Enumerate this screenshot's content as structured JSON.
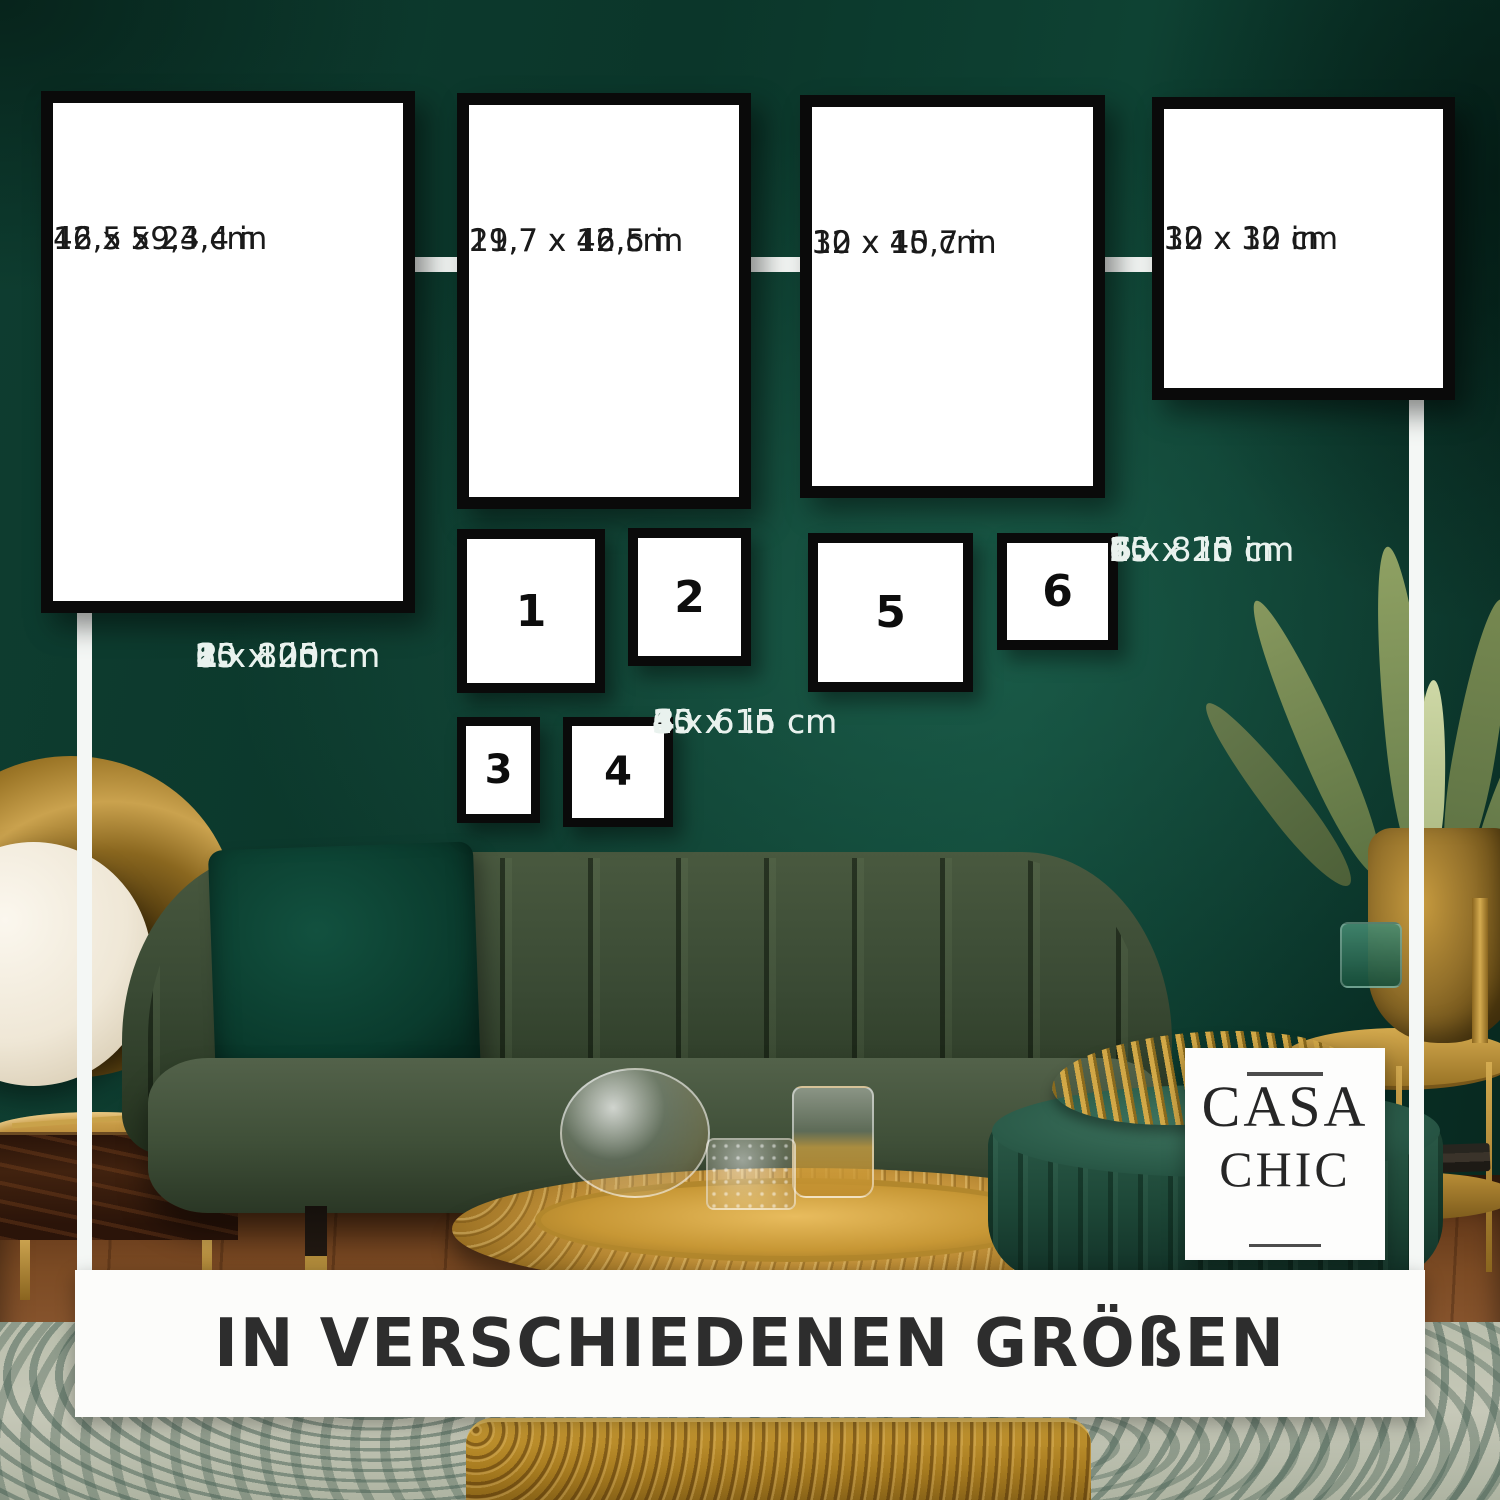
{
  "overlay": {
    "frames_large": [
      {
        "label_cm": "42 x 59,4 cm",
        "label_in": "16,5 x 23,4 in"
      },
      {
        "label_cm": "29,7 x 42 cm",
        "label_in": "11,7 x 16,5 in"
      },
      {
        "label_cm": "30 x 40 cm",
        "label_in": "12 x 15,7 in"
      },
      {
        "label_cm": "30 x 30 cm",
        "label_in": "12 x 12 in"
      }
    ],
    "frames_small": [
      {
        "num": "1"
      },
      {
        "num": "2"
      },
      {
        "num": "3"
      },
      {
        "num": "4"
      },
      {
        "num": "5"
      },
      {
        "num": "6"
      }
    ],
    "legend": [
      {
        "num": "1.",
        "cm": "20 x 25 cm",
        "in": "8 x 10 in"
      },
      {
        "num": "2.",
        "cm": "15 x 20 cm",
        "in": "6 x 8 in"
      },
      {
        "num": "3.",
        "cm": "10 x 15 cm",
        "in": "4 x 6 in"
      },
      {
        "num": "4.",
        "cm": "15 x 15 cm",
        "in": "6 x 6 in"
      },
      {
        "num": "5.",
        "cm": "25 x 25 cm",
        "in": "10 x 10 in"
      },
      {
        "num": "6.",
        "cm": "20 x 20 cm",
        "in": "8 x 8 in"
      }
    ],
    "logo": {
      "line1": "CASA",
      "line2": "CHIC"
    },
    "banner": {
      "text": "IN VERSCHIEDENEN GRÖßEN"
    }
  },
  "colors": {
    "wall_green": "#0c3a2e",
    "frame_border": "#0a0a0a",
    "frame_fill": "#ffffff",
    "connector_white": "#f4f7f5",
    "banner_bg": "#fcfcfa",
    "banner_text": "#2d2d2d",
    "legend_text": "#e9f2ee",
    "gold_accent": "#c59a3f",
    "sofa_green": "#3a4a34",
    "pillow_green": "#0c4435"
  }
}
